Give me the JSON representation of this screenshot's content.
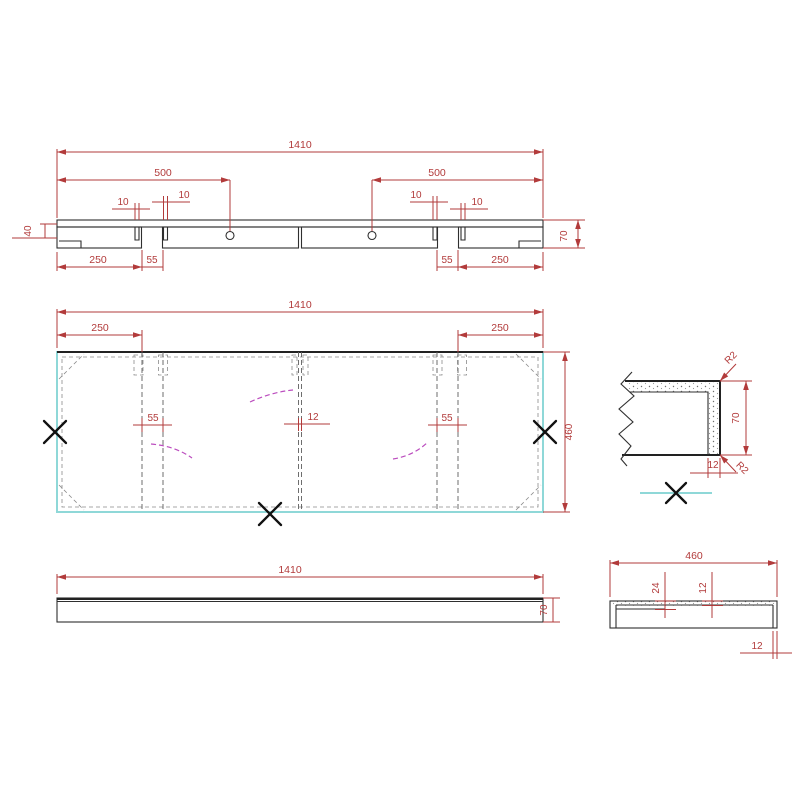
{
  "colors": {
    "dimension": "#b23b3b",
    "outline": "#2f2f2f",
    "hidden_line": "#5f5f5f",
    "panel_edge_cyan": "#8fd8d8",
    "assembly_arc_magenta": "#bb4cbe",
    "mark_black": "#111111",
    "background": "#ffffff"
  },
  "views": {
    "section": {
      "dims": {
        "overall": "1410",
        "left_500": "500",
        "right_500": "500",
        "slot_10_a": "10",
        "slot_10_b": "10",
        "slot_10_c": "10",
        "slot_10_d": "10",
        "left_250": "250",
        "left_55": "55",
        "right_55": "55",
        "right_250": "250",
        "height_40": "40",
        "height_70": "70"
      }
    },
    "plan": {
      "dims": {
        "overall": "1410",
        "left_250": "250",
        "right_250": "250",
        "left_55": "55",
        "center_12": "12",
        "right_55": "55",
        "depth_460": "460"
      }
    },
    "elevation": {
      "dims": {
        "overall": "1410",
        "height_70": "70"
      }
    },
    "end": {
      "dims": {
        "width_460": "460",
        "offset_24": "24",
        "offset_12": "12",
        "lip_12": "12"
      }
    },
    "detail": {
      "dims": {
        "radius_top": "R2",
        "radius_bottom": "R2",
        "height_70": "70",
        "thickness_12": "12"
      }
    }
  }
}
